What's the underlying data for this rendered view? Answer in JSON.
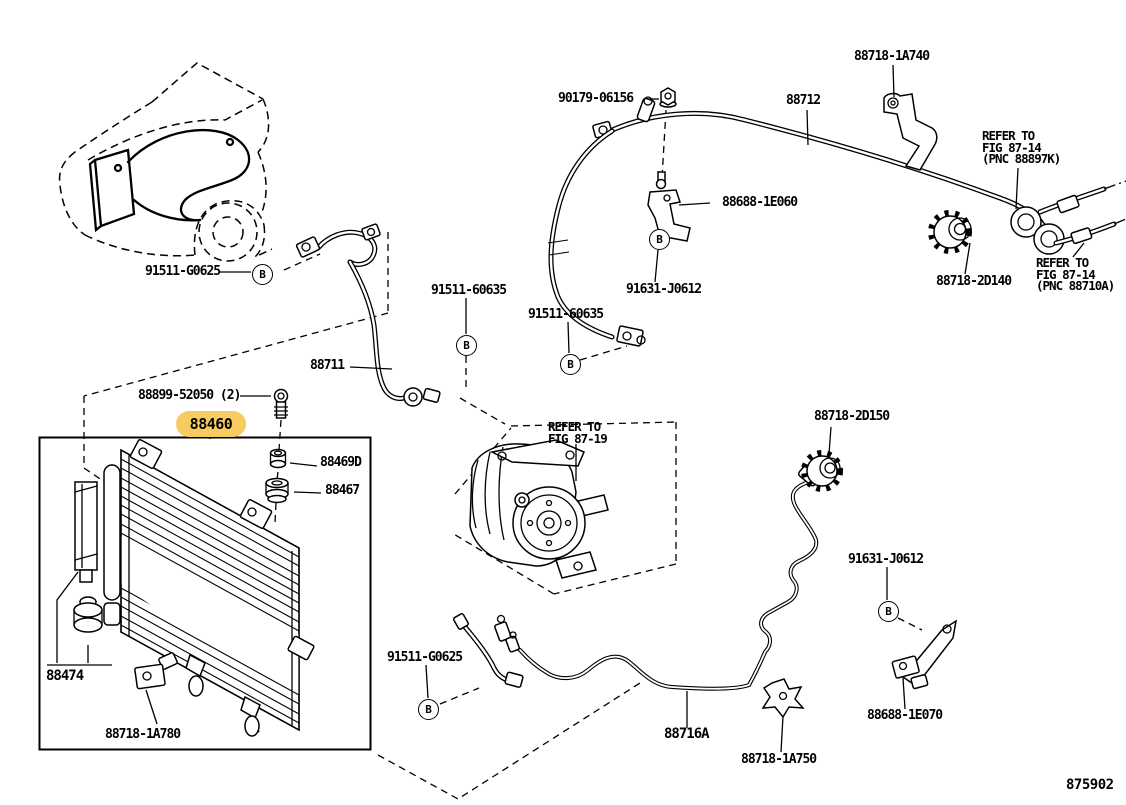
{
  "figure": {
    "code": "875902",
    "marker_letter": "B",
    "highlight_color": "#F7CB62",
    "line_color": "#000000",
    "background_color": "#FFFFFF",
    "highlighted_part_number": "88460"
  },
  "parts": {
    "nut": "90179-06156",
    "discharge_pipe": "88712",
    "bracket_1a740": "88718-1A740",
    "bracket_1e060": "88688-1E060",
    "bolt_j0612": "91631-J0612",
    "bolt_60635": "91511-60635",
    "grommet_2d140": "88718-2D140",
    "bolt_g0625": "91511-G0625",
    "suction_hose": "88711",
    "screw_52050": "88899-52050 (2)",
    "condenser": "88460",
    "cushion_469d": "88469D",
    "cushion_467": "88467",
    "grommet_2d150": "88718-2D150",
    "receiver_drier": "88474",
    "clamp_1a780": "88718-1A780",
    "liquid_tube": "88716A",
    "clamp_1a750": "88718-1A750",
    "bracket_1e070": "88688-1E070"
  },
  "notes": {
    "refer_87_14_upper": [
      "REFER TO",
      "FIG 87-14",
      "(PNC 88897K)"
    ],
    "refer_87_14_lower": [
      "REFER TO",
      "FIG 87-14",
      "(PNC 88710A)"
    ],
    "refer_87_19": [
      "REFER TO",
      "FIG 87-19"
    ]
  }
}
